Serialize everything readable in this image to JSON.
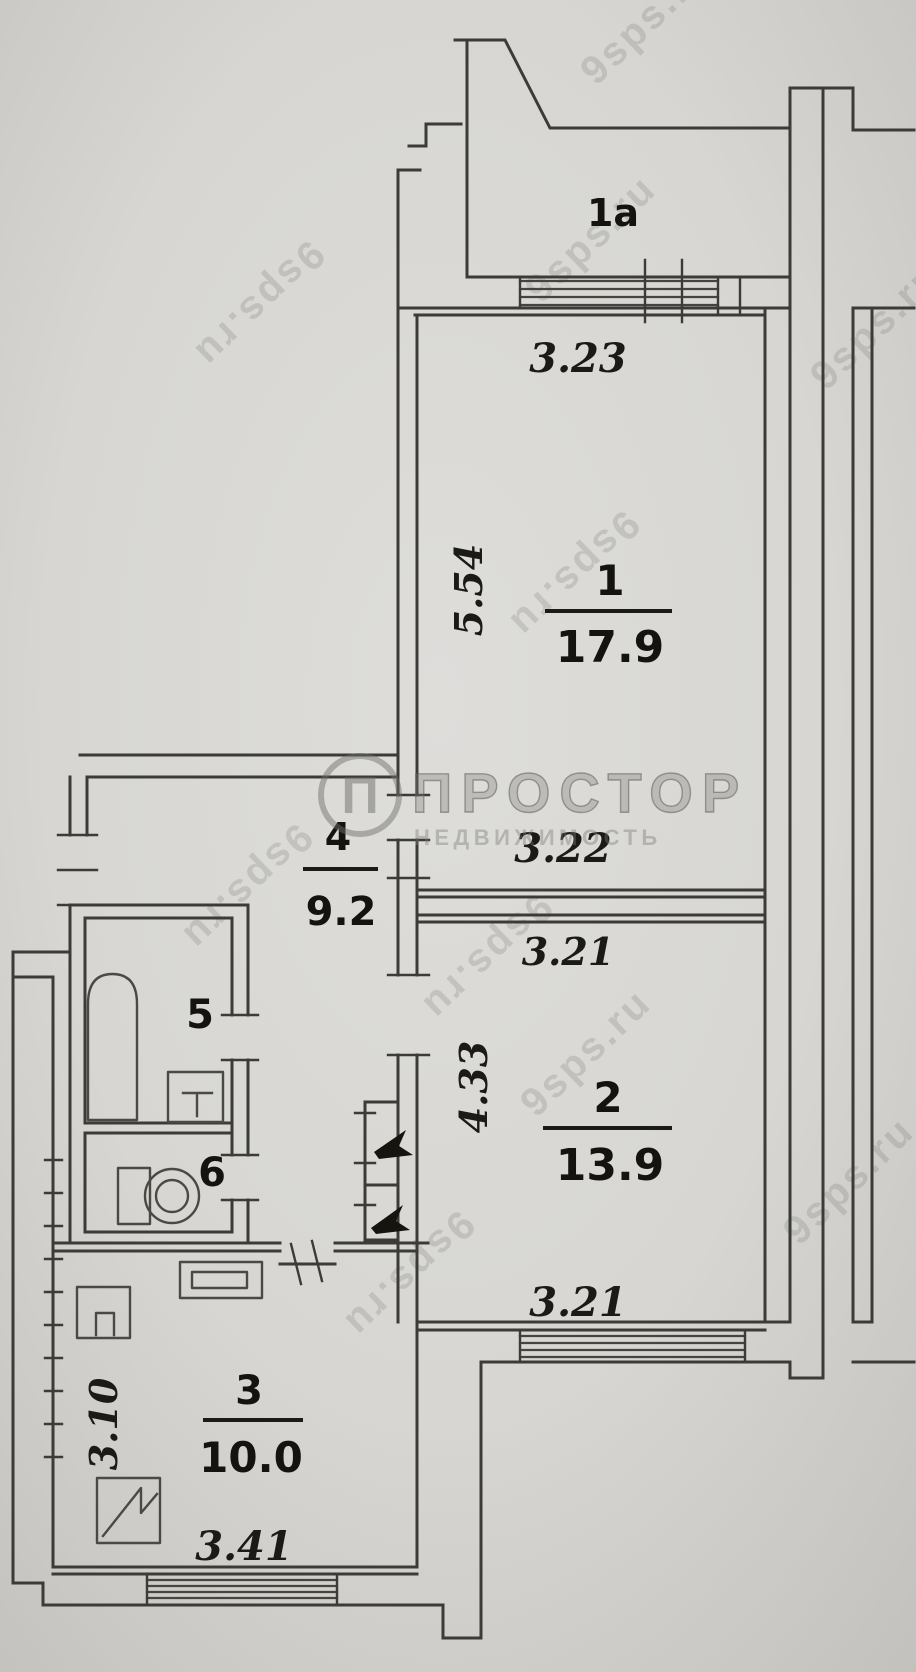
{
  "plan": {
    "balcony": {
      "label": "1a"
    },
    "room1": {
      "number": "1",
      "area": "17.9",
      "width_top": "3.23",
      "depth": "5.54",
      "width_bottom": "3.22"
    },
    "room2": {
      "number": "2",
      "area": "13.9",
      "width_top": "3.21",
      "depth": "4.33",
      "width_bottom": "3.21"
    },
    "room3": {
      "number": "3",
      "area": "10.0",
      "depth": "3.10",
      "width": "3.41"
    },
    "room4": {
      "number": "4",
      "area": "9.2"
    },
    "room5": {
      "number": "5"
    },
    "room6": {
      "number": "6"
    }
  },
  "watermark": {
    "brand": "ПРОСТОР",
    "subtitle": "НЕДВИЖИМОСТЬ",
    "logo_letter": "П",
    "site": "9sps.ru"
  }
}
